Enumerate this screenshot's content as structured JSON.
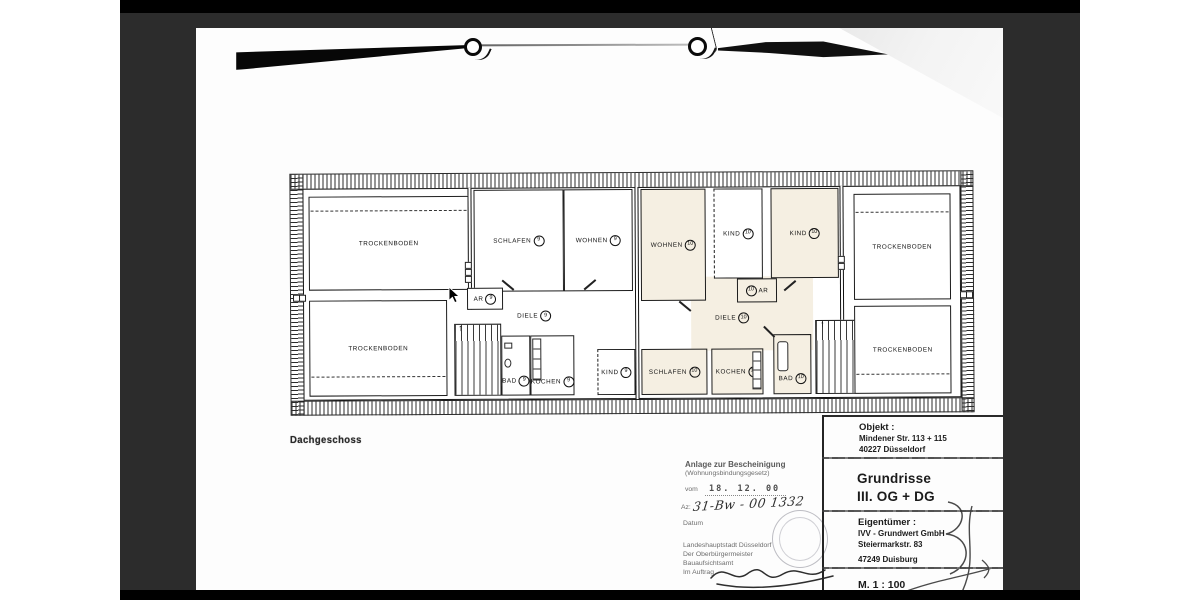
{
  "colors": {
    "viewer_background": "#2c2c2c",
    "letterbox_bar": "#000000",
    "page": "#fdfdfd",
    "highlight_room": "#f5efe2",
    "plan_line": "#1d1d1d"
  },
  "page": {
    "plan_title": "Dachgeschoss"
  },
  "plan": {
    "stair_arrow": "↑",
    "rooms": [
      {
        "label": "TROCKENBODEN",
        "unit": ""
      },
      {
        "label": "SCHLAFEN",
        "unit": "9"
      },
      {
        "label": "WOHNEN",
        "unit": "9"
      },
      {
        "label": "WOHNEN",
        "unit": "10"
      },
      {
        "label": "KIND",
        "unit": "10"
      },
      {
        "label": "KIND",
        "unit": "10"
      },
      {
        "label": "TROCKENBODEN",
        "unit": ""
      },
      {
        "label": "AR",
        "unit": "9"
      },
      {
        "label": "DIELE",
        "unit": "9"
      },
      {
        "label": "AR",
        "unit": "10"
      },
      {
        "label": "DIELE",
        "unit": "10"
      },
      {
        "label": "TROCKENBODEN",
        "unit": ""
      },
      {
        "label": "BAD",
        "unit": "9"
      },
      {
        "label": "KOCHEN",
        "unit": "9"
      },
      {
        "label": "KIND",
        "unit": "9"
      },
      {
        "label": "SCHLAFEN",
        "unit": "10"
      },
      {
        "label": "KOCHEN",
        "unit": "10"
      },
      {
        "label": "BAD",
        "unit": "10"
      },
      {
        "label": "TROCKENBODEN",
        "unit": ""
      }
    ]
  },
  "stamp": {
    "line1": "Anlage zur Bescheinigung",
    "line2": "(Wohnungsbindungsgesetz)",
    "date_label": "vom",
    "date_value": "18. 12. 00",
    "az_label": "Az:",
    "file_number": "31-Bw - 00 1332",
    "datum_label": "Datum",
    "authority_line1": "Landeshauptstadt Düsseldorf",
    "authority_line2": "Der Oberbürgermeister",
    "authority_line3": "Bauaufsichtsamt",
    "authority_line4": "Im Auftrag"
  },
  "title_block": {
    "object_heading": "Objekt :",
    "object_line1": "Mindener Str. 113 + 115",
    "object_line2": "40227 Düsseldorf",
    "drawing_heading": "Grundrisse",
    "drawing_line": "III. OG + DG",
    "owner_heading": "Eigentümer :",
    "owner_line1": "IVV - Grundwert GmbH",
    "owner_line2": "Steiermarkstr. 83",
    "owner_line3": "47249 Duisburg",
    "scale": "M. 1 : 100"
  }
}
